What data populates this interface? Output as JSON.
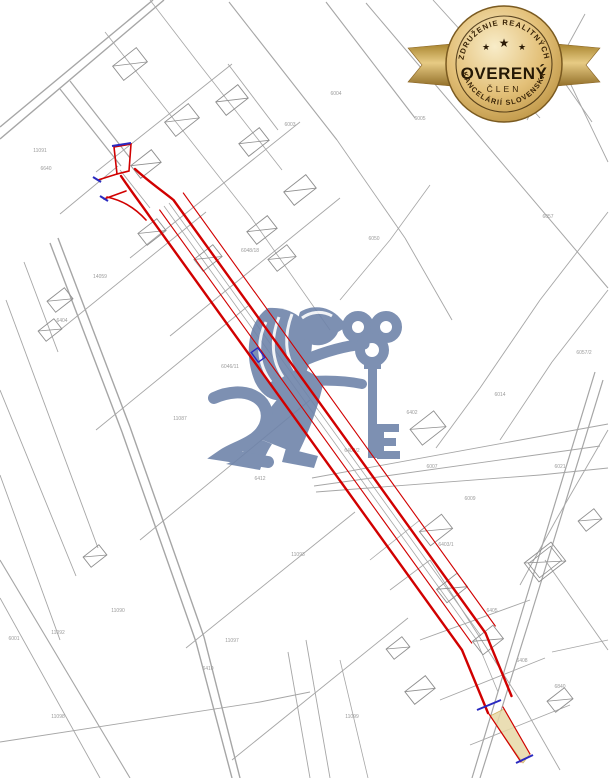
{
  "page": {
    "width": 609,
    "height": 778,
    "background": "#ffffff"
  },
  "badge": {
    "arc_top": "ZDRUŽENIE REALITNÝCH",
    "title": "OVERENÝ",
    "subtitle": "ČLEN",
    "arc_bottom": "KANCELÁRIÍ SLOVENSKA",
    "stars": [
      "★",
      "★",
      "★"
    ],
    "gold_dark": "#8a6526",
    "gold_mid": "#d9b461",
    "gold_light": "#f8ecc8",
    "text_color": "#2a1a06"
  },
  "watermark": {
    "name": "lion-with-key-logo",
    "color": "#6f84aa",
    "opacity": 0.9
  },
  "map": {
    "line_color": "#a6a6a6",
    "road_color": "#8f8f8f",
    "label_color": "#9b9b9b",
    "lines": [
      [
        0,
        127,
        153,
        0,
        1.4
      ],
      [
        0,
        139,
        164,
        0,
        1.4
      ],
      [
        60,
        89,
        121,
        166,
        1.2
      ],
      [
        70,
        81,
        130,
        158,
        1.2
      ],
      [
        50,
        243,
        122,
        432,
        1.4
      ],
      [
        58,
        238,
        130,
        427,
        1.4
      ],
      [
        122,
        432,
        196,
        642,
        1.4
      ],
      [
        130,
        427,
        204,
        637,
        1.4
      ],
      [
        196,
        642,
        232,
        778,
        1.4
      ],
      [
        204,
        637,
        240,
        778,
        1.4
      ],
      [
        6,
        300,
        98,
        548,
        0.9
      ],
      [
        0,
        390,
        76,
        576,
        0.9
      ],
      [
        24,
        262,
        58,
        352,
        0.9
      ],
      [
        0,
        475,
        60,
        640,
        0.9
      ],
      [
        0,
        560,
        130,
        778,
        1.1
      ],
      [
        0,
        598,
        100,
        778,
        0.9
      ],
      [
        229,
        2,
        337,
        140,
        1.1
      ],
      [
        326,
        2,
        415,
        118,
        1.1
      ],
      [
        228,
        64,
        278,
        130,
        0.9
      ],
      [
        337,
        140,
        405,
        238,
        0.9
      ],
      [
        405,
        238,
        452,
        320,
        0.9
      ],
      [
        366,
        3,
        608,
        288,
        1.0
      ],
      [
        433,
        0,
        540,
        118,
        0.9
      ],
      [
        518,
        16,
        592,
        122,
        0.9
      ],
      [
        585,
        14,
        527,
        120,
        0.9
      ],
      [
        560,
        62,
        608,
        162,
        0.9
      ],
      [
        608,
        212,
        540,
        300,
        0.9
      ],
      [
        540,
        300,
        480,
        388,
        0.9
      ],
      [
        480,
        388,
        436,
        448,
        0.9
      ],
      [
        608,
        290,
        552,
        362,
        0.9
      ],
      [
        552,
        362,
        500,
        440,
        0.9
      ],
      [
        595,
        372,
        522,
        612,
        1.2
      ],
      [
        603,
        380,
        530,
        618,
        1.2
      ],
      [
        522,
        612,
        472,
        778,
        1.2
      ],
      [
        530,
        618,
        480,
        778,
        1.2
      ],
      [
        608,
        430,
        556,
        520,
        0.9
      ],
      [
        556,
        520,
        520,
        585,
        0.9
      ],
      [
        312,
        478,
        608,
        424,
        0.9
      ],
      [
        314,
        486,
        600,
        446,
        0.9
      ],
      [
        316,
        492,
        540,
        475,
        0.9
      ],
      [
        540,
        475,
        608,
        468,
        0.9
      ],
      [
        96,
        172,
        232,
        64,
        0.9
      ],
      [
        130,
        258,
        300,
        122,
        0.9
      ],
      [
        118,
        166,
        60,
        214,
        0.9
      ],
      [
        170,
        336,
        340,
        198,
        0.9
      ],
      [
        150,
        0,
        196,
        60,
        0.8
      ],
      [
        196,
        60,
        282,
        170,
        0.8
      ],
      [
        105,
        32,
        250,
        216,
        0.8
      ],
      [
        250,
        216,
        330,
        330,
        0.8
      ],
      [
        60,
        330,
        206,
        212,
        0.9
      ],
      [
        96,
        430,
        248,
        306,
        0.9
      ],
      [
        140,
        540,
        310,
        400,
        0.9
      ],
      [
        186,
        648,
        355,
        512,
        0.9
      ],
      [
        232,
        760,
        408,
        618,
        0.9
      ],
      [
        0,
        742,
        260,
        702,
        0.9
      ],
      [
        260,
        702,
        310,
        692,
        0.9
      ],
      [
        306,
        640,
        330,
        778,
        0.9
      ],
      [
        288,
        652,
        310,
        778,
        0.9
      ],
      [
        340,
        660,
        368,
        778,
        0.8
      ],
      [
        430,
        560,
        520,
        700,
        0.9
      ],
      [
        520,
        700,
        560,
        770,
        0.9
      ],
      [
        420,
        640,
        530,
        600,
        0.9
      ],
      [
        440,
        700,
        545,
        658,
        0.9
      ],
      [
        470,
        745,
        570,
        705,
        0.9
      ],
      [
        545,
        560,
        608,
        650,
        0.9
      ],
      [
        390,
        590,
        430,
        560,
        0.8
      ],
      [
        552,
        652,
        608,
        640,
        0.8
      ],
      [
        164,
        206,
        476,
        639,
        0.8
      ],
      [
        169,
        203,
        481,
        636,
        0.8
      ],
      [
        476,
        639,
        498,
        692,
        0.8
      ],
      [
        150,
        208,
        120,
        170,
        0.9
      ],
      [
        340,
        300,
        390,
        240,
        0.8
      ],
      [
        390,
        240,
        430,
        185,
        0.8
      ],
      [
        370,
        560,
        420,
        520,
        0.8
      ]
    ],
    "houses": [
      [
        130,
        64,
        30,
        18,
        -38,
        0
      ],
      [
        182,
        120,
        30,
        18,
        -38,
        0
      ],
      [
        146,
        164,
        26,
        16,
        -38,
        0
      ],
      [
        232,
        100,
        28,
        17,
        -38,
        0
      ],
      [
        254,
        142,
        26,
        16,
        -38,
        0
      ],
      [
        300,
        190,
        28,
        17,
        -38,
        0
      ],
      [
        262,
        230,
        26,
        16,
        -38,
        0
      ],
      [
        152,
        232,
        24,
        15,
        -38,
        0
      ],
      [
        208,
        258,
        24,
        15,
        -38,
        0
      ],
      [
        282,
        258,
        24,
        15,
        -38,
        0
      ],
      [
        60,
        300,
        22,
        14,
        -38,
        0
      ],
      [
        50,
        330,
        20,
        13,
        -38,
        0
      ],
      [
        95,
        556,
        20,
        13,
        -38,
        0
      ],
      [
        428,
        428,
        30,
        20,
        -38,
        0
      ],
      [
        436,
        530,
        28,
        18,
        -38,
        0
      ],
      [
        452,
        588,
        26,
        17,
        -38,
        0
      ],
      [
        488,
        640,
        26,
        17,
        -38,
        0
      ],
      [
        545,
        562,
        34,
        24,
        -38,
        1
      ],
      [
        420,
        690,
        26,
        16,
        -38,
        0
      ],
      [
        398,
        648,
        20,
        13,
        -38,
        0
      ],
      [
        560,
        700,
        22,
        14,
        -38,
        0
      ],
      [
        590,
        520,
        20,
        13,
        -38,
        0
      ]
    ],
    "labels": [
      [
        46,
        170,
        "6640"
      ],
      [
        40,
        152,
        "11091"
      ],
      [
        548,
        218,
        "6057"
      ],
      [
        336,
        95,
        "6004"
      ],
      [
        290,
        126,
        "6003"
      ],
      [
        14,
        640,
        "6001"
      ],
      [
        58,
        634,
        "11092"
      ],
      [
        118,
        612,
        "11090"
      ],
      [
        100,
        278,
        "14059"
      ],
      [
        62,
        322,
        "6404"
      ],
      [
        250,
        252,
        "6048/18"
      ],
      [
        352,
        452,
        "6402/2"
      ],
      [
        432,
        468,
        "6007"
      ],
      [
        470,
        500,
        "6009"
      ],
      [
        298,
        556,
        "11093"
      ],
      [
        232,
        642,
        "11097"
      ],
      [
        208,
        670,
        "6410"
      ],
      [
        352,
        718,
        "11099"
      ],
      [
        560,
        468,
        "6021"
      ],
      [
        500,
        396,
        "6014"
      ],
      [
        584,
        354,
        "6057/2"
      ],
      [
        412,
        414,
        "6402"
      ],
      [
        446,
        546,
        "6403/1"
      ],
      [
        492,
        612,
        "6405"
      ],
      [
        522,
        662,
        "6408"
      ],
      [
        560,
        688,
        "6840"
      ],
      [
        374,
        240,
        "6050"
      ],
      [
        420,
        120,
        "6005"
      ],
      [
        230,
        368,
        "6046/11"
      ],
      [
        180,
        420,
        "11087"
      ],
      [
        260,
        480,
        "6412"
      ],
      [
        58,
        718,
        "11098"
      ]
    ]
  },
  "parcel": {
    "red": "#d10000",
    "blue": "#2a2ac0",
    "tan_fill": "#e7d9a8",
    "tan_edge": "#caa84e",
    "red_paths": [
      {
        "d": "M121,176 C131,191 141,204 150,217 L462,650 L488,713",
        "w": 2.4
      },
      {
        "d": "M135,169 C148,181 161,190 173.5,200 L485.5,633 L511.5,696",
        "w": 2.4
      },
      {
        "d": "M159.7,210 L471.7,643",
        "w": 1.1
      },
      {
        "d": "M183.3,193 L495.3,626",
        "w": 1.1
      },
      {
        "d": "M114,147 L131,144 L129,171 L117,174 Z",
        "w": 1.6
      },
      {
        "d": "M117,174 L98,180",
        "w": 1.6
      },
      {
        "d": "M126,191 L104,199",
        "w": 1.6
      },
      {
        "d": "M107,197 Q130,202 146,220",
        "w": 1.6
      },
      {
        "d": "M489,714 L521,762",
        "w": 1.2
      },
      {
        "d": "M503,707 L530,754",
        "w": 1.2
      }
    ],
    "tan_polygon": "490,716 504,709 530,754 523,763",
    "blue_marks": [
      [
        112,
        146,
        131,
        143
      ],
      [
        93,
        177,
        101,
        182
      ],
      [
        100,
        196,
        108,
        201
      ],
      [
        477,
        710,
        501,
        700
      ],
      [
        516,
        763,
        533,
        755
      ]
    ],
    "blue_rect": {
      "x": 252,
      "y": 351,
      "w": 12,
      "h": 8,
      "rot": 54
    }
  }
}
